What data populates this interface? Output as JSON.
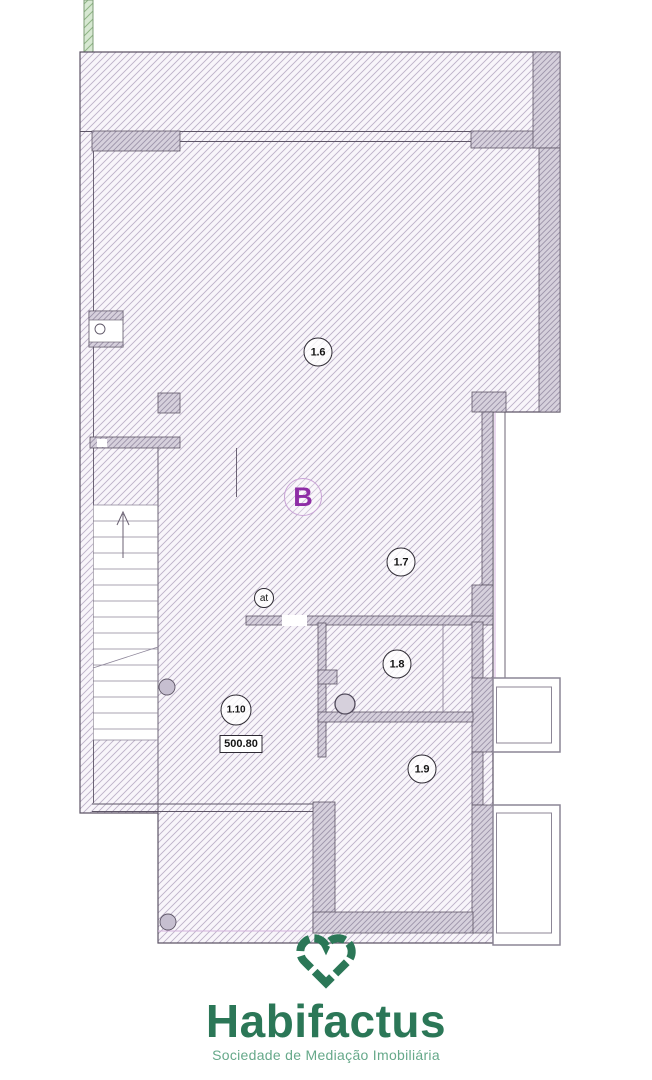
{
  "plan": {
    "block_label": "B",
    "door_label": "at",
    "level_label": "500.80",
    "rooms": {
      "r16": "1.6",
      "r17": "1.7",
      "r18": "1.8",
      "r19": "1.9",
      "r110": "1.10"
    }
  },
  "logo": {
    "name": "Habifactus",
    "tagline": "Sociedade de Mediação Imobiliária"
  },
  "colors": {
    "hatch_line": "#bcb1c7",
    "hatch_bg": "#f8f5fa",
    "wall_fill": "#d6d0dc",
    "wall_hatch_line": "#9d93aa",
    "outline": "#5d5566",
    "accent_lavender": "#d5b3dd",
    "green_strip_bg": "#d7e8d2",
    "green_strip_line": "#8fb585",
    "block_purple": "#8e2da6",
    "logo_green": "#2b7757",
    "logo_green_light": "#66a98a"
  }
}
